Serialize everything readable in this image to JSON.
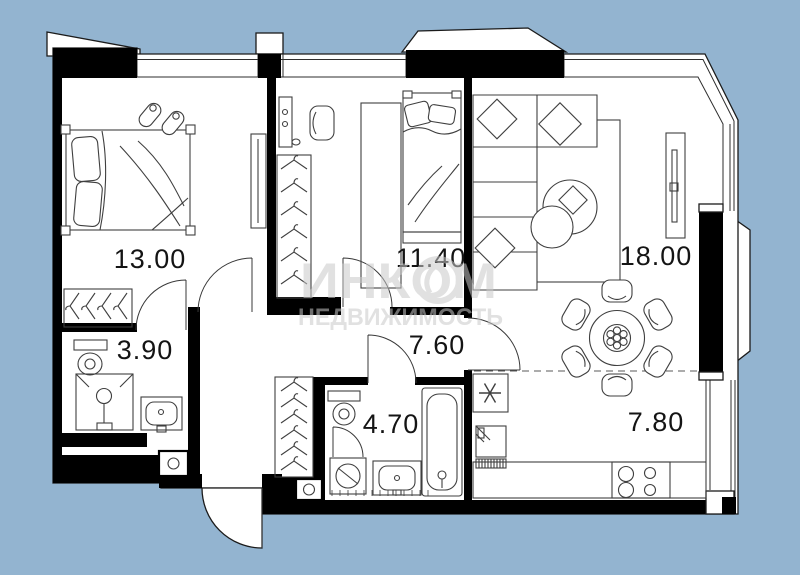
{
  "watermark": {
    "brand": "ИНКОМ",
    "subtitle": "НЕДВИЖИМОСТЬ"
  },
  "rooms": [
    {
      "name": "bedroom-1",
      "area": "13.00"
    },
    {
      "name": "bedroom-2",
      "area": "11.40"
    },
    {
      "name": "living-room",
      "area": "18.00"
    },
    {
      "name": "bathroom-1",
      "area": "3.90"
    },
    {
      "name": "hallway",
      "area": "7.60"
    },
    {
      "name": "bathroom-2",
      "area": "4.70"
    },
    {
      "name": "kitchen",
      "area": "7.80"
    }
  ],
  "colors": {
    "background": "#93b4d0",
    "wall": "#000000",
    "line": "#3f3f3f",
    "watermark": "#c9c9c9",
    "label": "#141414"
  }
}
